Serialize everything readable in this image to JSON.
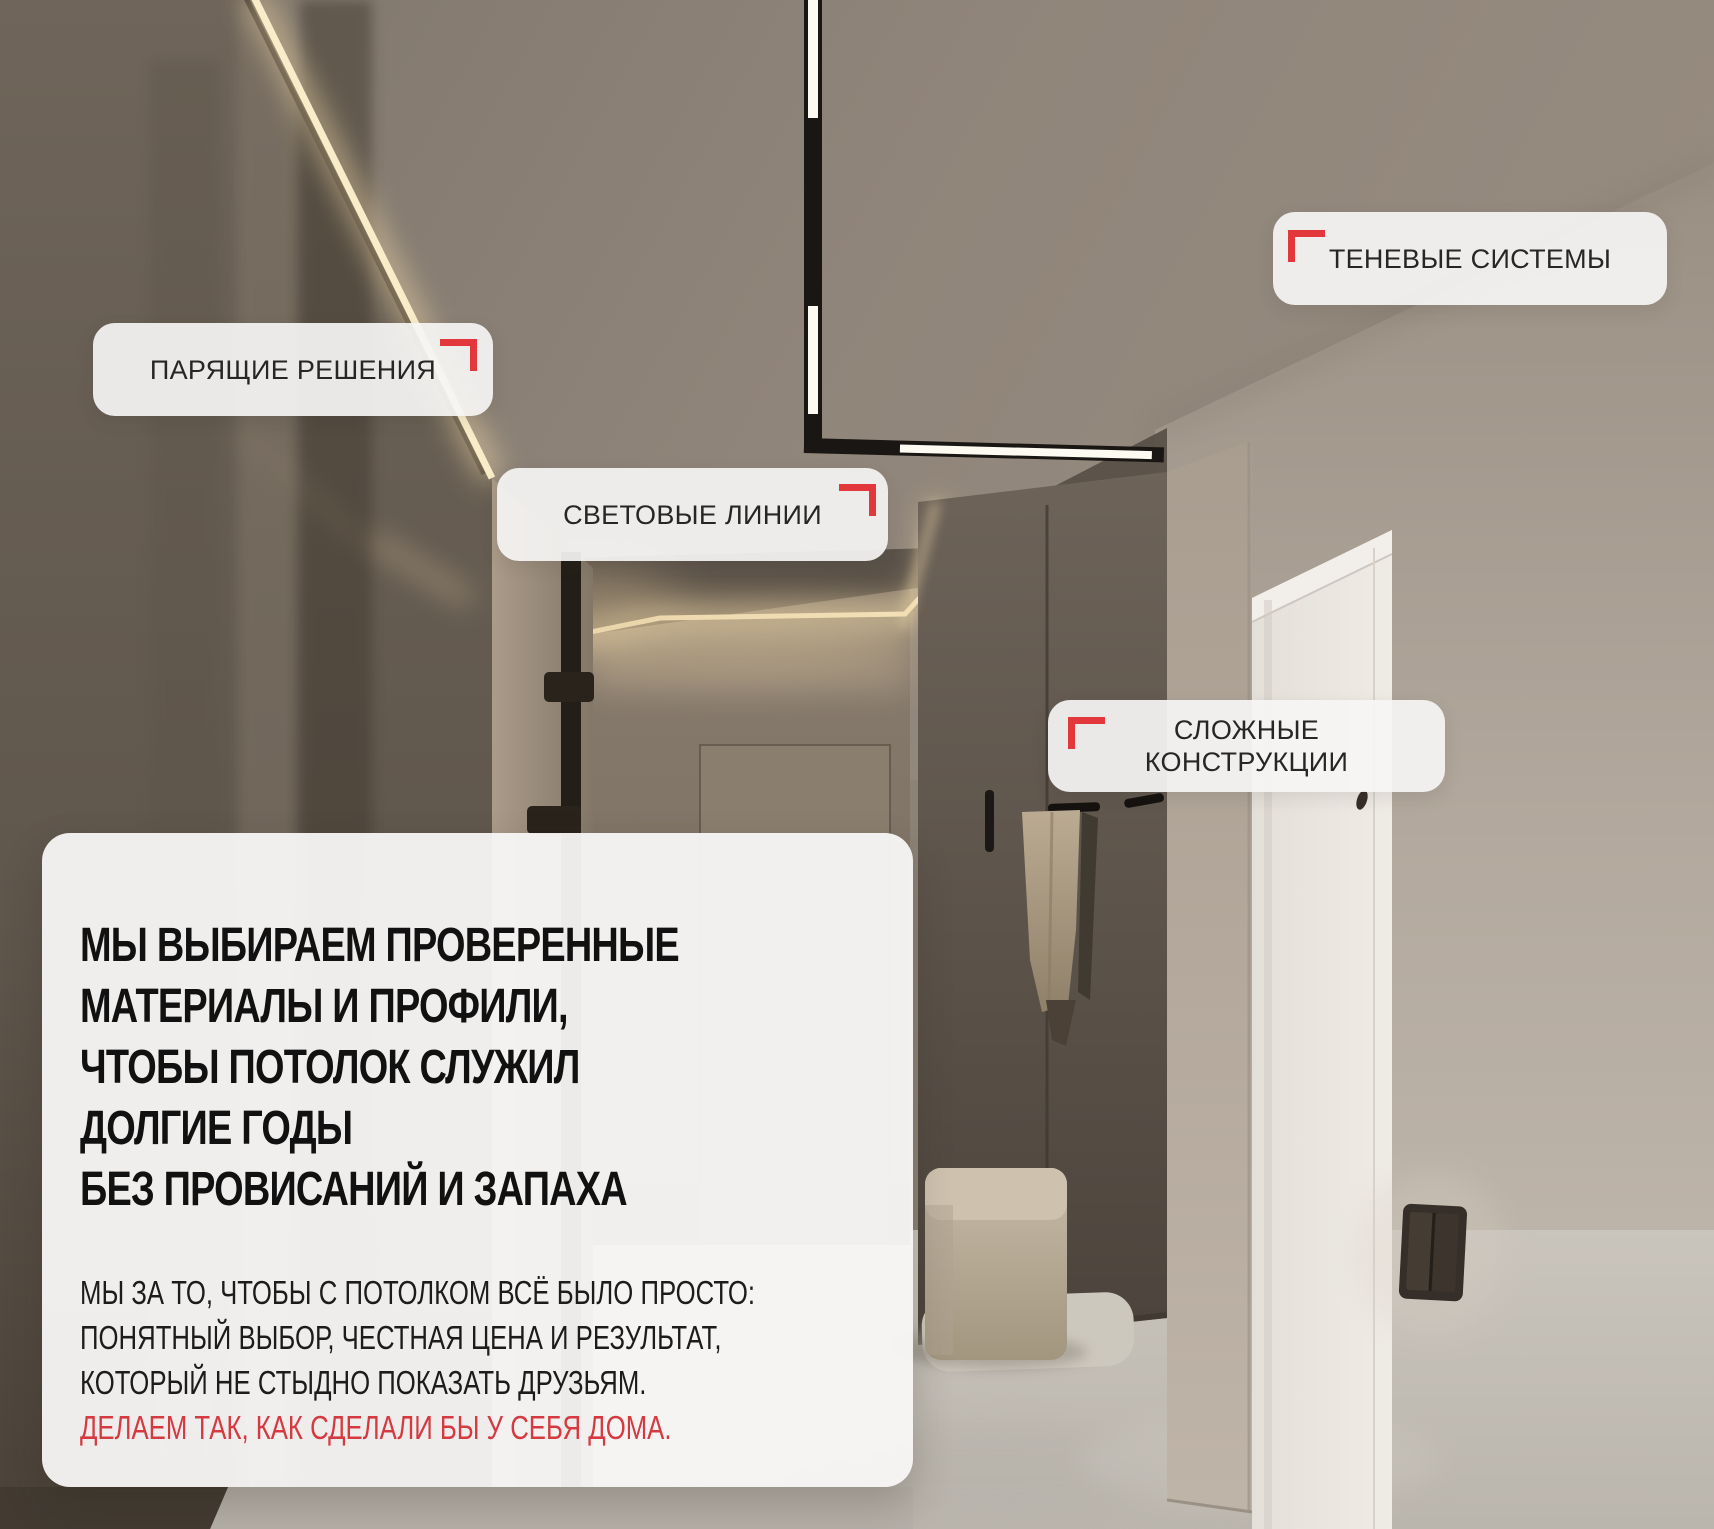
{
  "canvas": {
    "width": 1714,
    "height": 1529
  },
  "callouts": [
    {
      "label": "ПАРЯЩИЕ РЕШЕНИЯ",
      "bracket_corner": "top-right"
    },
    {
      "label": "СВЕТОВЫЕ ЛИНИИ",
      "bracket_corner": "top-right"
    },
    {
      "label": "ТЕНЕВЫЕ СИСТЕМЫ",
      "bracket_corner": "top-left"
    },
    {
      "label": "СЛОЖНЫЕ\nКОНСТРУКЦИИ",
      "bracket_corner": "top-left"
    }
  ],
  "info_panel": {
    "headline": "МЫ ВЫБИРАЕМ ПРОВЕРЕННЫЕ\nМАТЕРИАЛЫ И ПРОФИЛИ,\nЧТОБЫ ПОТОЛОК СЛУЖИЛ\nДОЛГИЕ ГОДЫ\nБЕЗ ПРОВИСАНИЙ И ЗАПАХА",
    "body": "МЫ ЗА ТО, ЧТОБЫ С ПОТОЛКОМ ВСЁ БЫЛО ПРОСТО:\nПОНЯТНЫЙ ВЫБОР, ЧЕСТНАЯ ЦЕНА И РЕЗУЛЬТАТ,\nКОТОРЫЙ НЕ СТЫДНО ПОКАЗАТЬ ДРУЗЬЯМ.",
    "highlight": "ДЕЛАЕМ ТАК, КАК СДЕЛАЛИ БЫ У СЕБЯ ДОМА."
  },
  "colors": {
    "accent_red": "#E2383C",
    "highlight_text_red": "#D53A40",
    "headline_text": "#111111",
    "body_text": "#1C1C1C",
    "callout_bg": "rgba(246,245,244,0.92)",
    "panel_bg": "rgba(248,247,245,0.95)"
  }
}
